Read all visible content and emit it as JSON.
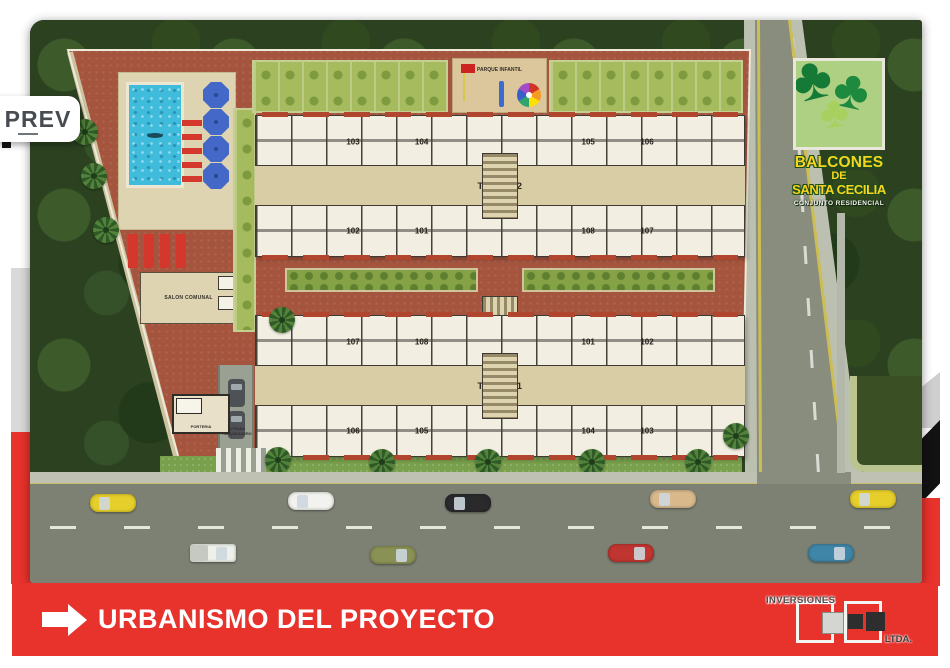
{
  "ui": {
    "prev_label": "PREV",
    "banner_title": "URBANISMO DEL PROYECTO",
    "footer_brand": {
      "name": "INVERSIONES",
      "suffix": "LTDA."
    }
  },
  "sign": {
    "line1": "BALCONES",
    "line2": "DE",
    "line3": "SANTA CECILIA",
    "subtitle": "CONJUNTO RESIDENCIAL"
  },
  "site": {
    "labels": {
      "parque_infantil": "PARQUE INFANTIL",
      "salon_comunal": "SALON COMUNAL",
      "porteria": "PORTERIA",
      "entrada_parqueadero": "ENTRADA PARQUEADERO"
    },
    "towers": [
      {
        "name": "TORRE 2",
        "top_units": [
          "103",
          "104",
          "105",
          "106"
        ],
        "bottom_units": [
          "102",
          "101",
          "108",
          "107"
        ]
      },
      {
        "name": "TORRE 1",
        "top_units": [
          "107",
          "108",
          "101",
          "102"
        ],
        "bottom_units": [
          "106",
          "105",
          "104",
          "103"
        ]
      }
    ]
  },
  "scene": {
    "street_cars": [
      {
        "x": 60,
        "y": 474,
        "color": "#e6cf2a",
        "type": "car",
        "dir": "w"
      },
      {
        "x": 258,
        "y": 472,
        "color": "#f2f2ee",
        "type": "car",
        "dir": "w"
      },
      {
        "x": 415,
        "y": 474,
        "color": "#2a2a2c",
        "type": "car",
        "dir": "w"
      },
      {
        "x": 620,
        "y": 470,
        "color": "#d9b98c",
        "type": "car",
        "dir": "w"
      },
      {
        "x": 820,
        "y": 470,
        "color": "#e6cf2a",
        "type": "car",
        "dir": "w"
      },
      {
        "x": 160,
        "y": 524,
        "color": "#eef0ea",
        "type": "truck",
        "dir": "e"
      },
      {
        "x": 340,
        "y": 526,
        "color": "#8a9154",
        "type": "car",
        "dir": "e"
      },
      {
        "x": 578,
        "y": 524,
        "color": "#c03530",
        "type": "car",
        "dir": "e"
      },
      {
        "x": 778,
        "y": 524,
        "color": "#3f85a8",
        "type": "car",
        "dir": "e"
      }
    ],
    "palms": [
      {
        "x": 55,
        "y": 112
      },
      {
        "x": 64,
        "y": 156
      },
      {
        "x": 76,
        "y": 210
      },
      {
        "x": 252,
        "y": 300
      },
      {
        "x": 248,
        "y": 440
      },
      {
        "x": 352,
        "y": 442
      },
      {
        "x": 458,
        "y": 442
      },
      {
        "x": 562,
        "y": 442
      },
      {
        "x": 668,
        "y": 442
      },
      {
        "x": 706,
        "y": 416
      }
    ],
    "colors": {
      "accent_red": "#e8322c",
      "ground_brick": "#a5553e",
      "pool_blue": "#3fbcdc",
      "trees_dark": "#2b4120",
      "sign_yellow": "#f7d41f"
    }
  }
}
